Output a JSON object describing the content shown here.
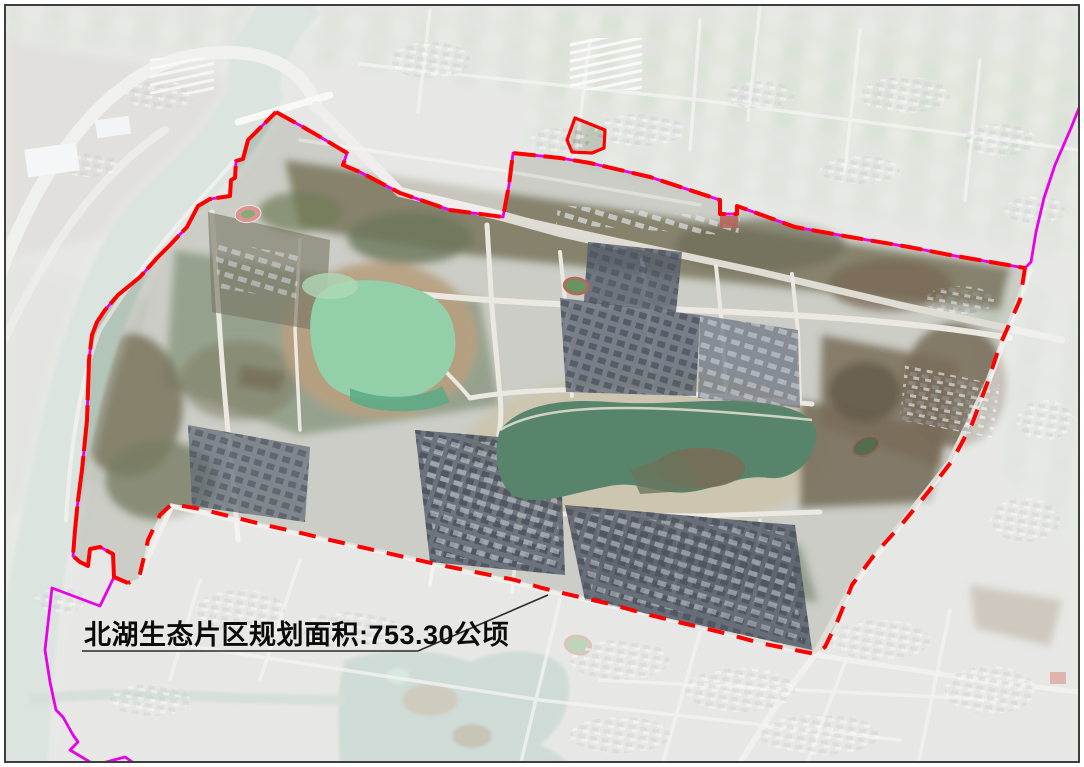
{
  "figure": {
    "type": "satellite-planning-map",
    "annotation": {
      "text": "北湖生态片区规划面积:753.30公顷",
      "region_name": "北湖生态片区",
      "metric_label": "规划面积",
      "area_value": "753.30",
      "area_unit": "公顷"
    },
    "colors": {
      "planning-boundary": "#ff0000",
      "eco-boundary": "#e800e8",
      "annotation-text": "#0b0b0b",
      "leader-line": "#2b2b2b",
      "frame": "#3e3e3e",
      "outside-wash": "rgba(255,255,255,0.54)",
      "big-lake": "#4a7a60",
      "small-lake": "#8acda2",
      "river": "#9db3a7"
    },
    "geometry": {
      "red_west_points": "128,583 114,577 113,554 100,547 90,549 88,566 80,562 73,556 75,530 78,500 82,470 87,420 89,360 92,335 97,322 105,310 118,295 140,277 157,258 170,245 187,227 198,206 210,199 230,196 231,180 235,178 236,161 243,159 248,140 276,112",
      "red_north_points": "276,112 303,127 322,138 347,153 343,165 360,172 400,193 450,210 503,217 509,185 513,153 560,158 590,163 650,177 720,200 720,214 737,214 737,206 795,227 850,237 909,247 950,255 1025,268",
      "red_east_south_points": "1025,268 1020,300 1000,345 987,384 972,424 952,461 929,491 902,524 875,554 852,585 838,620 825,647 815,654 795,650 760,643 720,632 682,623 650,615 610,604 575,596 542,588 515,580 480,573 440,565 400,556 365,548 330,540 297,532 265,525 233,517 200,509 172,504 160,515 148,540 139,578 128,583",
      "magenta_ne_points": "1025,268 1031,262 1036,232 1044,198 1055,165 1071,128 1083,98",
      "magenta_sw_points": "114,577 100,606 52,588 45,650 50,682 56,710 63,717 73,735 78,742 70,750 95,765 125,757 138,766",
      "parcel_d": "M575,118 L605,130 L604,148 L592,153 L572,152 L567,140 Z",
      "wash_d": "M6,6 L1078,6 L1078,761 L6,761 Z M276,112 L303,127 L322,138 L347,153 L343,165 L360,172 L400,193 L450,210 L503,217 L509,185 L513,153 L560,158 L590,163 L650,177 L720,200 L720,214 L737,214 L737,206 L795,227 L850,237 L909,247 L950,255 L1025,268 L1020,300 L1000,345 L987,384 L972,424 L952,461 L929,491 L902,524 L875,554 L852,585 L838,620 L825,647 L815,654 L795,650 L760,643 L720,632 L682,623 L650,615 L610,604 L575,596 L542,588 L515,580 L480,573 L440,565 L400,556 L365,548 L330,540 L297,532 L265,525 L233,517 L200,509 L172,504 L160,515 L148,540 L139,578 L128,583 L114,577 L113,554 L100,547 L90,549 L88,566 L80,562 L73,556 L75,530 L78,500 L82,470 L87,420 L89,360 L92,335 L97,322 L105,310 L118,295 L140,277 L157,258 L170,245 L187,227 L198,206 L210,199 L230,196 L231,180 L235,178 L236,161 L243,159 L248,140 Z M575,118 L605,130 L604,148 L592,153 L572,152 L567,140 Z",
      "underline_leader_d": "M82,651 L418,651 L548,595",
      "label_x": "84",
      "label_y": "644"
    }
  }
}
